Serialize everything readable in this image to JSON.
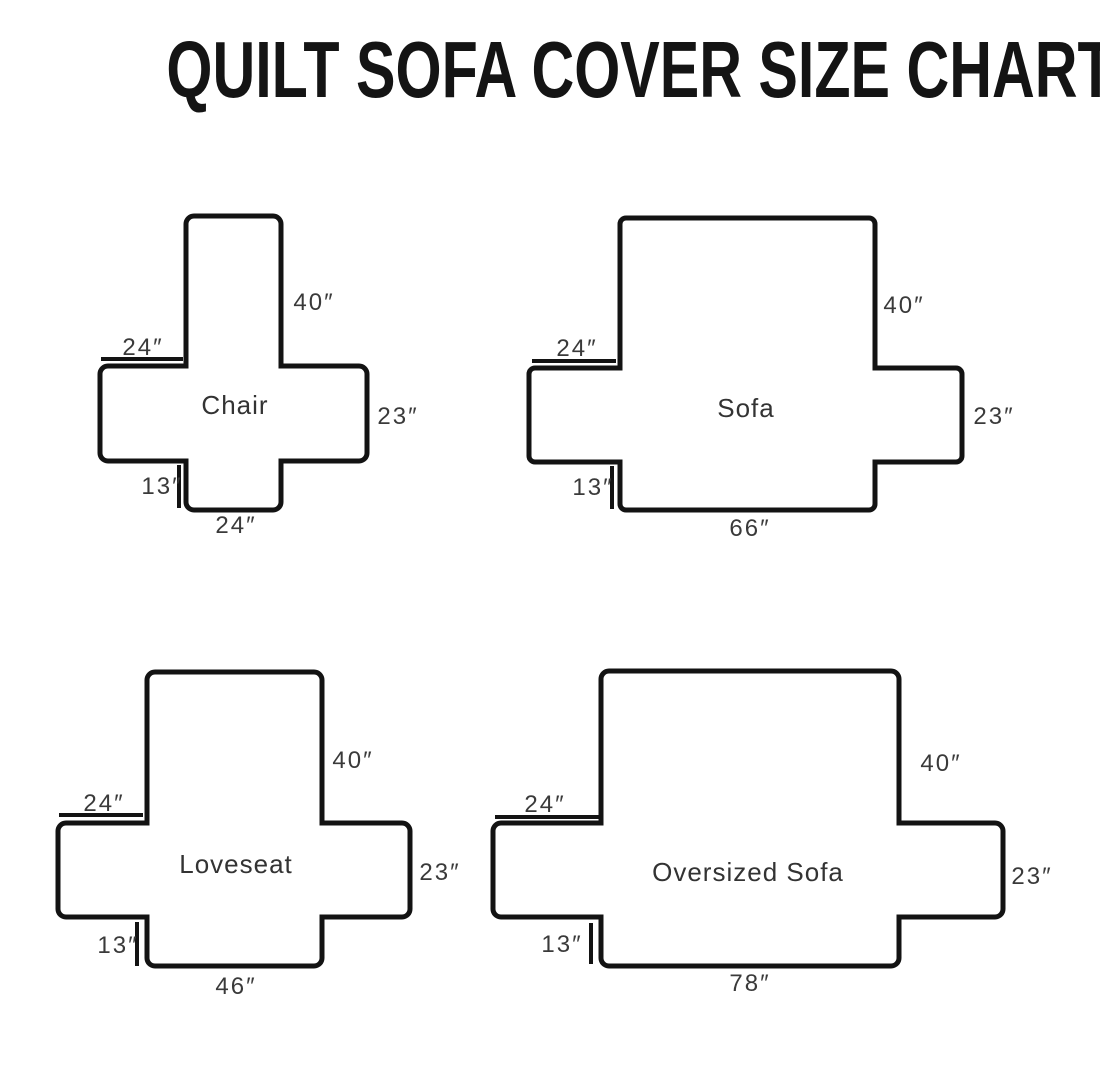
{
  "title": "QUILT SOFA COVER SIZE CHART",
  "colors": {
    "ink": "#131313",
    "label_text": "#3a3a3a",
    "background": "#ffffff"
  },
  "units": "inches",
  "diagrams": [
    {
      "id": "chair",
      "name": "Chair",
      "back_height": "40″",
      "arm_top_width": "24″",
      "arm_side_height": "23″",
      "front_skirt_height": "13″",
      "bottom_width": "24″"
    },
    {
      "id": "sofa",
      "name": "Sofa",
      "back_height": "40″",
      "arm_top_width": "24″",
      "arm_side_height": "23″",
      "front_skirt_height": "13″",
      "bottom_width": "66″"
    },
    {
      "id": "loveseat",
      "name": "Loveseat",
      "back_height": "40″",
      "arm_top_width": "24″",
      "arm_side_height": "23″",
      "front_skirt_height": "13″",
      "bottom_width": "46″"
    },
    {
      "id": "oversized-sofa",
      "name": "Oversized Sofa",
      "back_height": "40″",
      "arm_top_width": "24″",
      "arm_side_height": "23″",
      "front_skirt_height": "13″",
      "bottom_width": "78″"
    }
  ]
}
